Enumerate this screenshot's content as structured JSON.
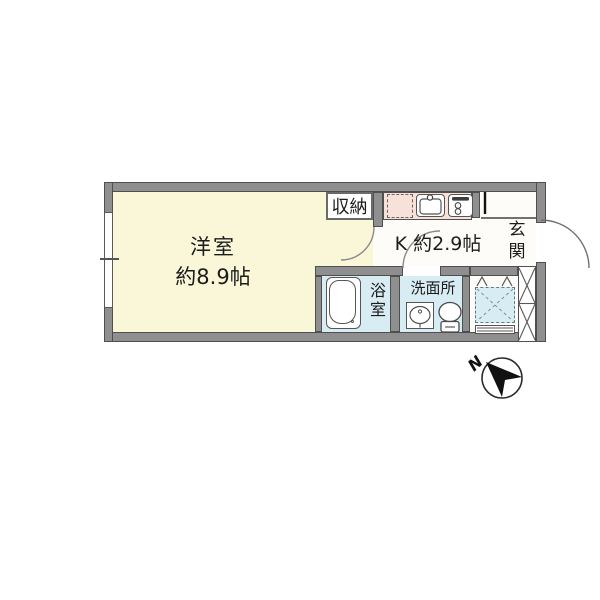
{
  "plan": {
    "living": {
      "name": "洋室",
      "size": "約8.9帖"
    },
    "kitchen": {
      "label": "K 約2.9帖"
    },
    "closet": {
      "label": "収納"
    },
    "entrance": {
      "char1": "玄",
      "char2": "関"
    },
    "bathroom": {
      "char1": "浴",
      "char2": "室"
    },
    "washroom": {
      "label": "洗面所"
    },
    "compass": {
      "label": "N"
    },
    "colors": {
      "room_fill": "#FAF7D8",
      "counter_fill": "#F7E1D9",
      "wet_area_fill": "#D8EDF3",
      "wall_fill": "#8F8F8F"
    }
  }
}
